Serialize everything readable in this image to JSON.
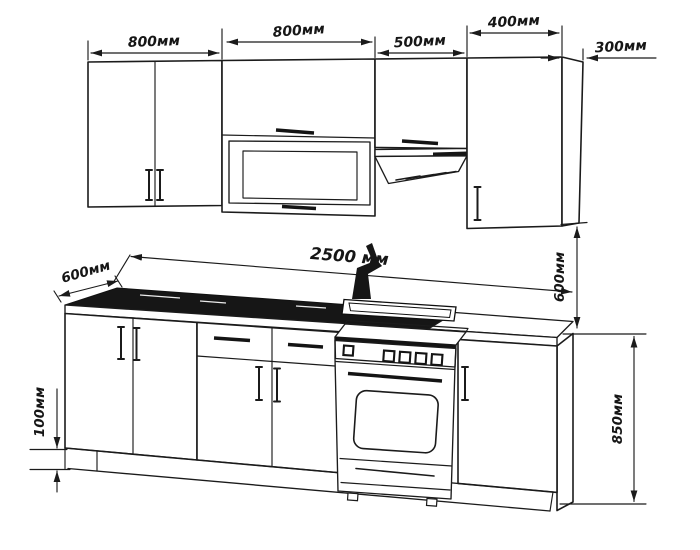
{
  "drawing": {
    "kind": "kitchen cabinet dimension drawing",
    "dimensions": {
      "upper_cabinet_1_width": "800мм",
      "upper_cabinet_2_width": "800мм",
      "upper_cabinet_3_width": "500мм",
      "upper_cabinet_4_width": "400мм",
      "upper_cabinet_depth": "300мм",
      "total_length": "2500 мм",
      "worktop_depth": "600мм",
      "worktop_to_upper_gap": "600мм",
      "base_cabinet_height": "850мм",
      "plinth_height": "100мм"
    },
    "colors": {
      "line": "#1b1b1b",
      "background": "#ffffff",
      "sink_fill": "#161616"
    }
  }
}
